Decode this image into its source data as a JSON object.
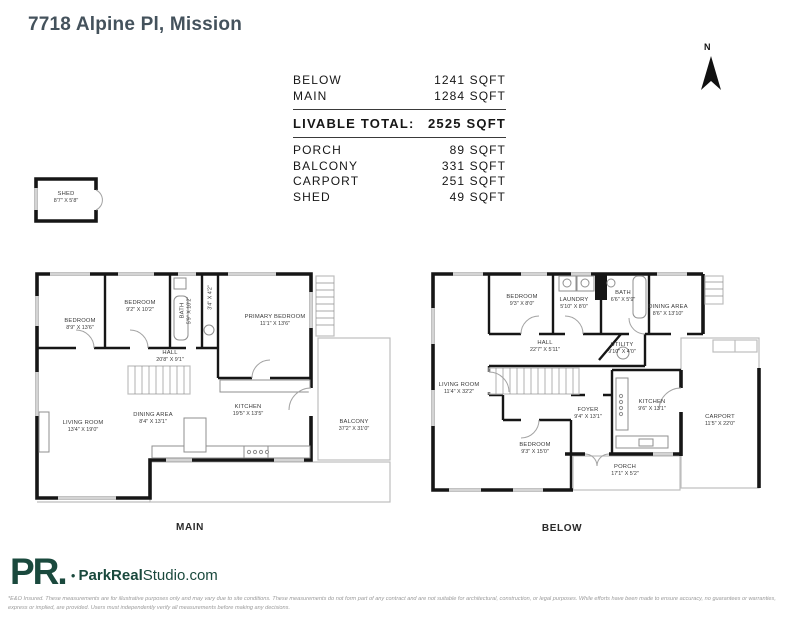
{
  "page": {
    "title": "7718 Alpine Pl, Mission"
  },
  "compass": {
    "label": "N"
  },
  "area_table": {
    "rows_top": [
      {
        "label": "BELOW",
        "value": "1241 SQFT"
      },
      {
        "label": "MAIN",
        "value": "1284 SQFT"
      }
    ],
    "total": {
      "label": "LIVABLE TOTAL:",
      "value": "2525 SQFT"
    },
    "rows_bottom": [
      {
        "label": "PORCH",
        "value": "89 SQFT"
      },
      {
        "label": "BALCONY",
        "value": "331 SQFT"
      },
      {
        "label": "CARPORT",
        "value": "251 SQFT"
      },
      {
        "label": "SHED",
        "value": "49 SQFT"
      }
    ]
  },
  "shed": {
    "name": "SHED",
    "dims": "8'7\" X 5'8\""
  },
  "plans": {
    "main": {
      "caption": "MAIN",
      "rooms": {
        "bedroom1": {
          "name": "BEDROOM",
          "dims": "8'9\" X 13'6\""
        },
        "bedroom2": {
          "name": "BEDROOM",
          "dims": "9'2\" X 10'2\""
        },
        "bath": {
          "name": "BATH",
          "dims": "5'9\" X 10'2\""
        },
        "wc": {
          "name": "",
          "dims": "3'4\" X 4'2\""
        },
        "primary_bedroom": {
          "name": "PRIMARY BEDROOM",
          "dims": "11'1\" X 13'6\""
        },
        "hall": {
          "name": "HALL",
          "dims": "20'8\" X 9'1\""
        },
        "living_room": {
          "name": "LIVING ROOM",
          "dims": "13'4\" X 19'0\""
        },
        "dining_area": {
          "name": "DINING AREA",
          "dims": "8'4\" X 13'1\""
        },
        "kitchen": {
          "name": "KITCHEN",
          "dims": "19'5\" X 13'5\""
        },
        "balcony": {
          "name": "BALCONY",
          "dims": "37'2\" X 31'0\""
        }
      }
    },
    "below": {
      "caption": "BELOW",
      "rooms": {
        "bedroom1": {
          "name": "BEDROOM",
          "dims": "9'3\" X 8'0\""
        },
        "laundry": {
          "name": "LAUNDRY",
          "dims": "5'10\" X 8'0\""
        },
        "bath": {
          "name": "BATH",
          "dims": "6'6\" X 5'9\""
        },
        "dining_area": {
          "name": "DINING AREA",
          "dims": "8'6\" X 13'10\""
        },
        "hall": {
          "name": "HALL",
          "dims": "22'7\" X 5'11\""
        },
        "utility": {
          "name": "UTILITY",
          "dims": "9'10\" X 4'0\""
        },
        "living_room": {
          "name": "LIVING ROOM",
          "dims": "11'4\" X 32'2\""
        },
        "bedroom2": {
          "name": "BEDROOM",
          "dims": "9'3\" X 15'0\""
        },
        "foyer": {
          "name": "FOYER",
          "dims": "9'4\" X 13'1\""
        },
        "kitchen": {
          "name": "KITCHEN",
          "dims": "9'6\" X 13'1\""
        },
        "carport": {
          "name": "CARPORT",
          "dims": "11'5\" X 22'0\""
        },
        "porch": {
          "name": "PORCH",
          "dims": "17'1\" X 5'2\""
        }
      }
    }
  },
  "footer": {
    "monogram": "PR.",
    "brand_bold": "ParkReal",
    "brand_rest": "Studio.com",
    "disclaimer": "*E&O Insured. These measurements are for illustrative purposes only and may vary due to site conditions. These measurements do not form part of any contract and are not suitable for architectural, construction, or legal purposes. While efforts have been made to ensure accuracy, no guarantees or warranties, express or implied, are provided. Users must independently verify all measurements before making any decisions."
  },
  "colors": {
    "brand_green": "#1a493d",
    "title_slate": "#44525c",
    "wall_black": "#161616"
  }
}
